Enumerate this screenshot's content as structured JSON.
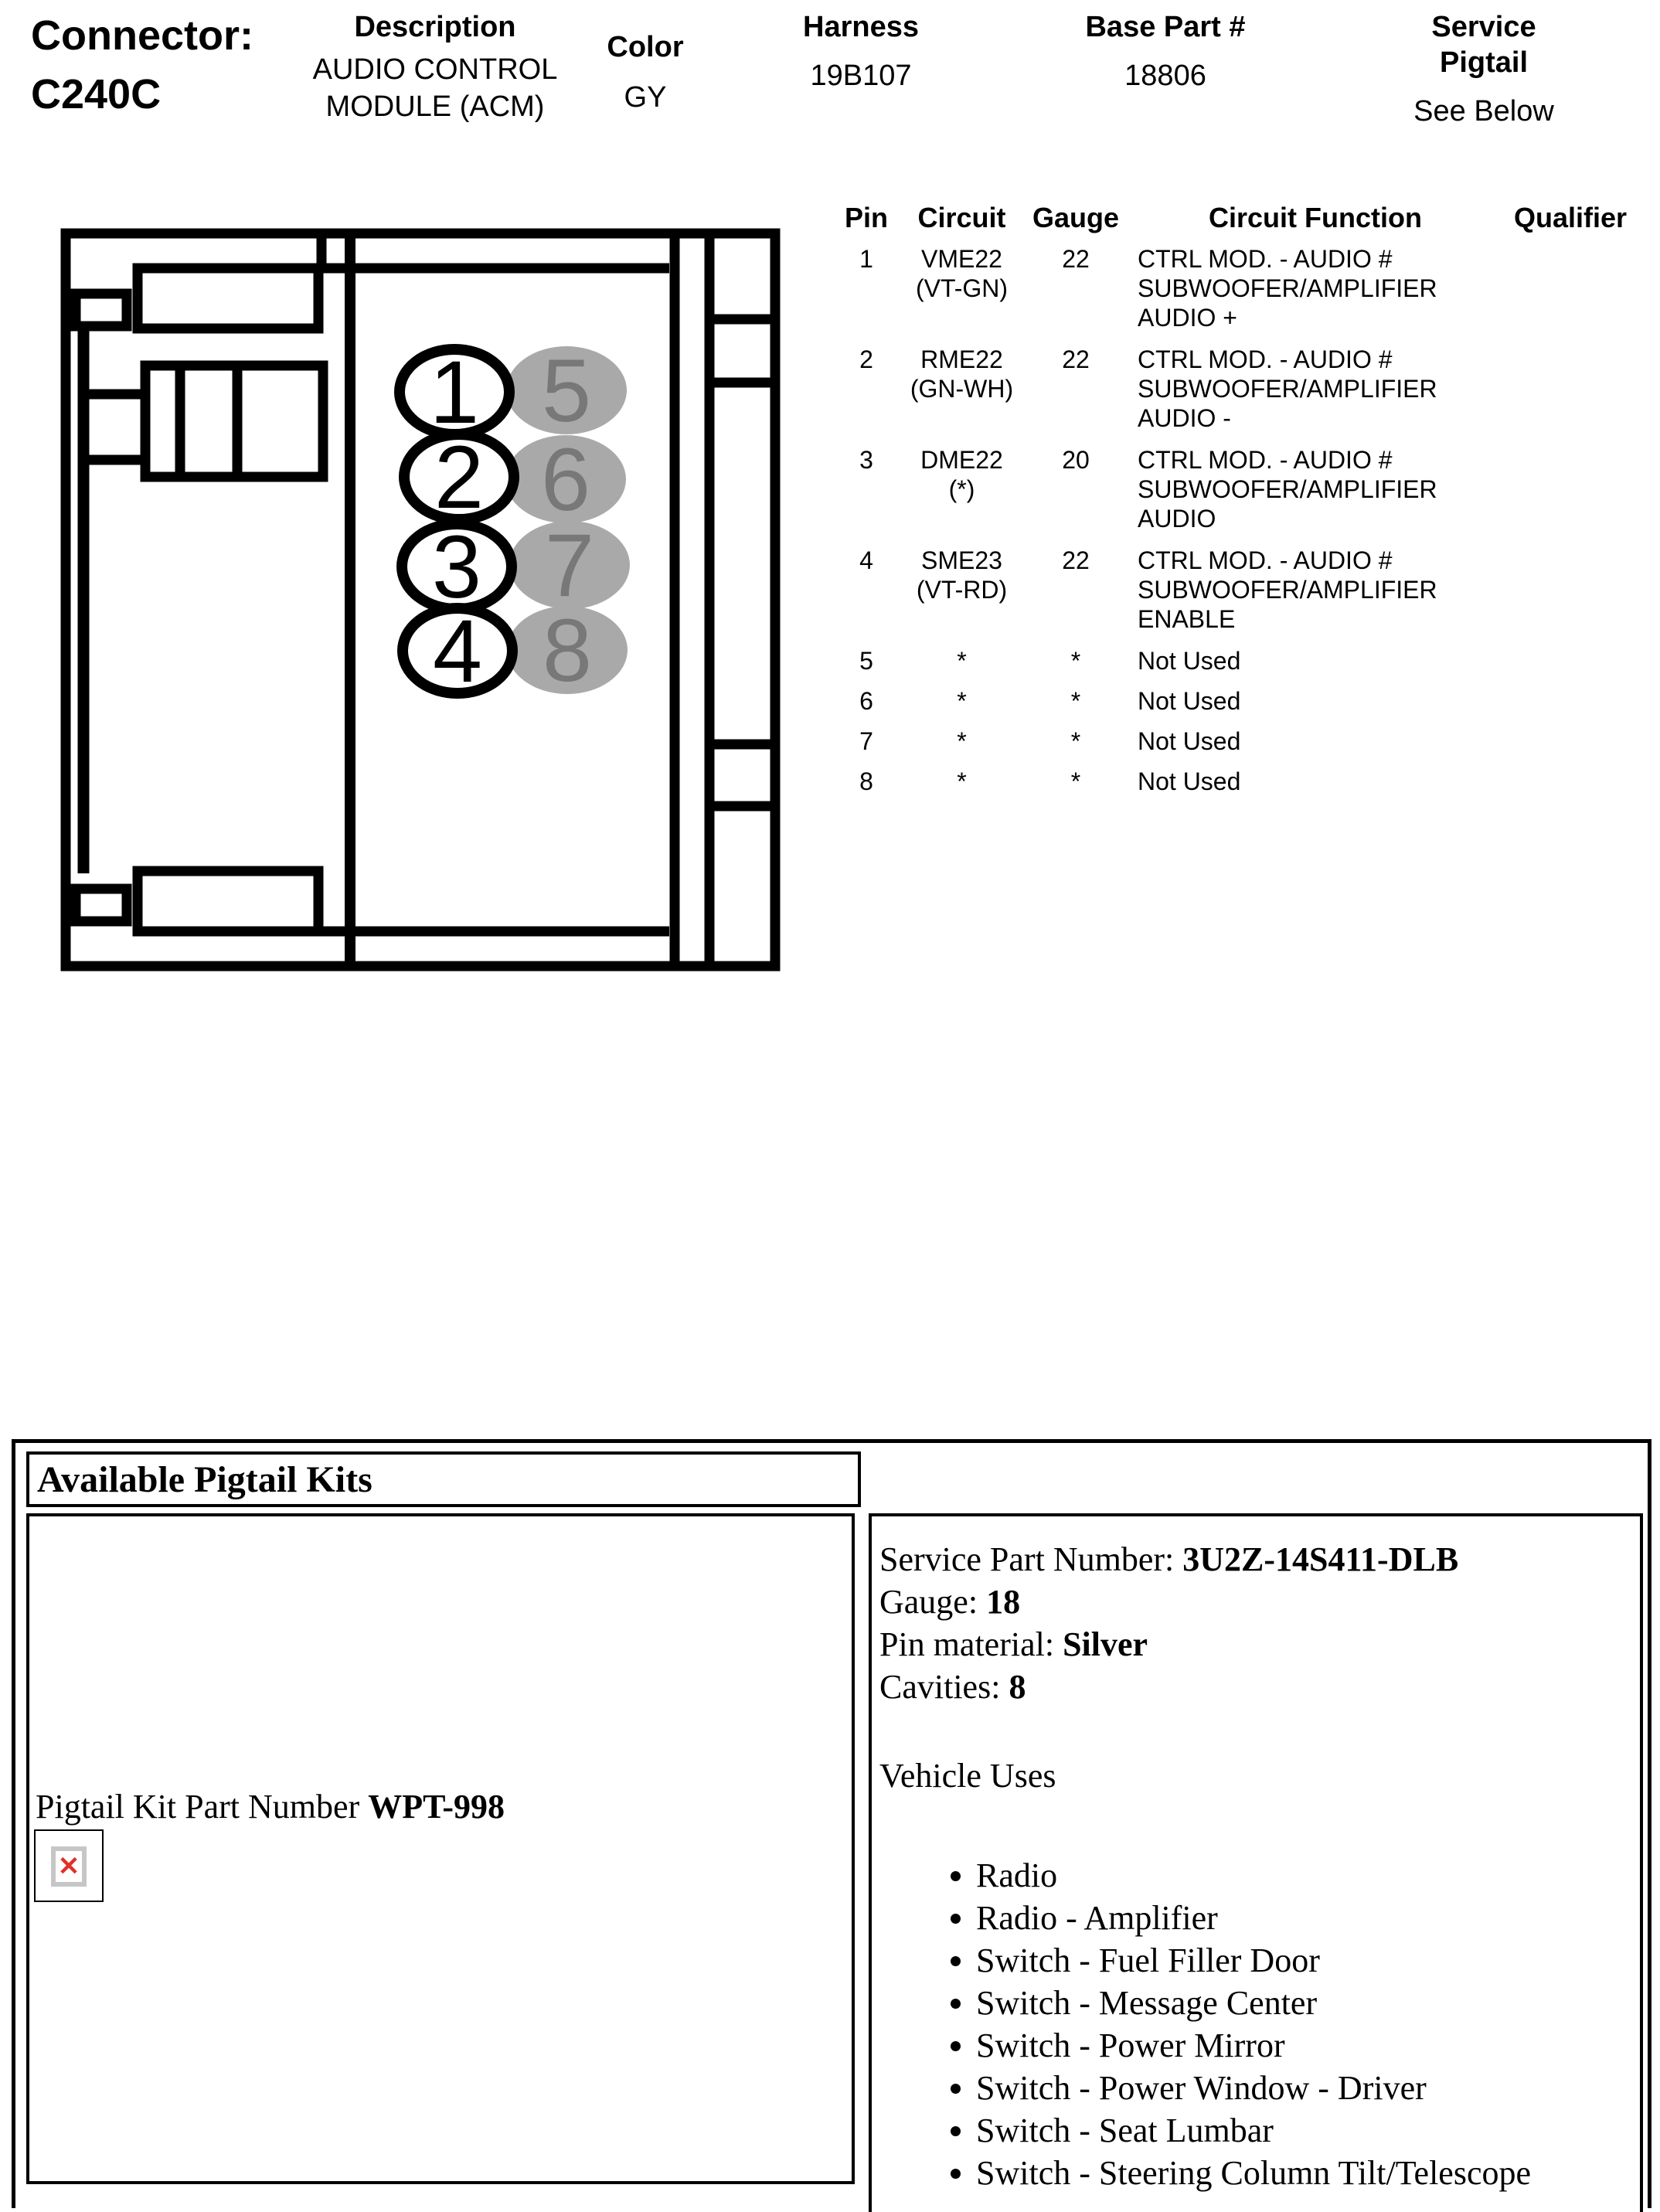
{
  "header": {
    "connector_label": "Connector:",
    "connector_id": "C240C",
    "description_label": "Description",
    "description_value": "AUDIO CONTROL\nMODULE (ACM)",
    "color_label": "Color",
    "color_value": "GY",
    "harness_label": "Harness",
    "harness_value": "19B107",
    "base_part_label": "Base Part #",
    "base_part_value": "18806",
    "service_pigtail_label": "Service Pigtail",
    "service_pigtail_value": "See Below"
  },
  "pin_table": {
    "headers": {
      "pin": "Pin",
      "circuit": "Circuit",
      "gauge": "Gauge",
      "function": "Circuit Function",
      "qualifier": "Qualifier"
    },
    "rows": [
      {
        "pin": "1",
        "circuit": "VME22\n(VT-GN)",
        "gauge": "22",
        "function": "CTRL MOD. - AUDIO #\nSUBWOOFER/AMPLIFIER\nAUDIO +",
        "qualifier": ""
      },
      {
        "pin": "2",
        "circuit": "RME22\n(GN-WH)",
        "gauge": "22",
        "function": "CTRL MOD. - AUDIO #\nSUBWOOFER/AMPLIFIER\nAUDIO -",
        "qualifier": ""
      },
      {
        "pin": "3",
        "circuit": "DME22 (*)",
        "gauge": "20",
        "function": "CTRL MOD. - AUDIO #\nSUBWOOFER/AMPLIFIER\nAUDIO",
        "qualifier": ""
      },
      {
        "pin": "4",
        "circuit": "SME23\n(VT-RD)",
        "gauge": "22",
        "function": "CTRL MOD. - AUDIO #\nSUBWOOFER/AMPLIFIER\nENABLE",
        "qualifier": ""
      },
      {
        "pin": "5",
        "circuit": "*",
        "gauge": "*",
        "function": "Not Used",
        "qualifier": ""
      },
      {
        "pin": "6",
        "circuit": "*",
        "gauge": "*",
        "function": "Not Used",
        "qualifier": ""
      },
      {
        "pin": "7",
        "circuit": "*",
        "gauge": "*",
        "function": "Not Used",
        "qualifier": ""
      },
      {
        "pin": "8",
        "circuit": "*",
        "gauge": "*",
        "function": "Not Used",
        "qualifier": ""
      }
    ]
  },
  "diagram": {
    "cavities": [
      "1",
      "2",
      "3",
      "4",
      "5",
      "6",
      "7",
      "8"
    ],
    "outline_color": "#000000",
    "used_cavity_fill": "#ffffff",
    "unused_cavity_fill": "#a9a9a9",
    "unused_number_color": "#787878"
  },
  "pigtail_section": {
    "title": "Available Pigtail Kits",
    "kit_label": "Pigtail Kit Part Number",
    "kit_number": "WPT-998",
    "broken_image_glyph": "✕",
    "service_part_label": "Service Part Number:",
    "service_part_value": "3U2Z-14S411-DLB",
    "gauge_label": "Gauge:",
    "gauge_value": "18",
    "pin_material_label": "Pin material:",
    "pin_material_value": "Silver",
    "cavities_label": "Cavities:",
    "cavities_value": "8",
    "vehicle_uses_label": "Vehicle Uses",
    "vehicle_uses": [
      "Radio",
      "Radio - Amplifier",
      "Switch - Fuel Filler Door",
      "Switch - Message Center",
      "Switch - Power Mirror",
      "Switch - Power Window - Driver",
      "Switch - Seat Lumbar",
      "Switch - Steering Column Tilt/Telescope"
    ]
  }
}
